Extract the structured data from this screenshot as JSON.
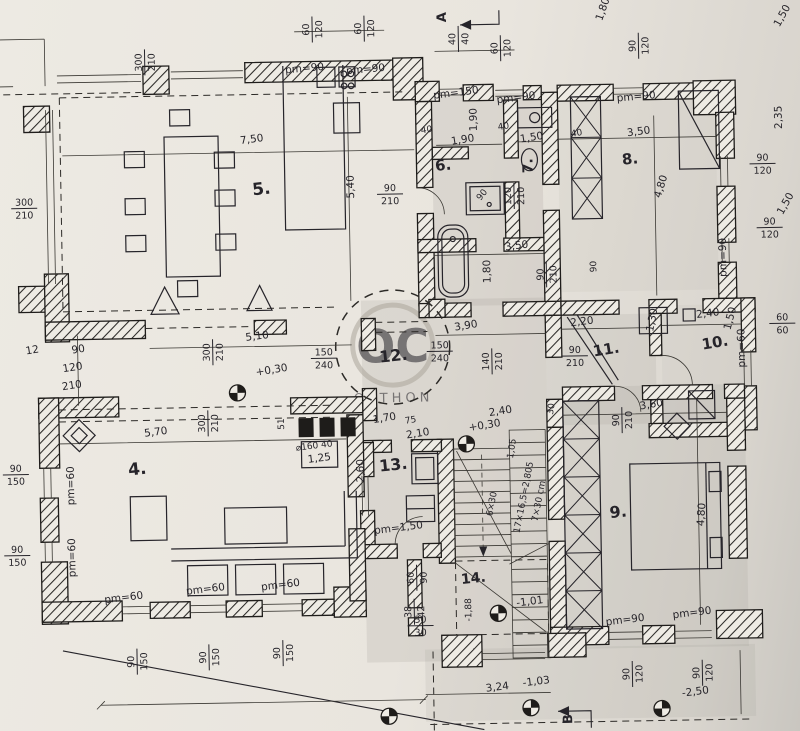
{
  "canvas": {
    "width": 800,
    "height": 731
  },
  "colors": {
    "paper": "#e9e5de",
    "paper_shadow": "#c9c6c0",
    "ink": "#26242a",
    "halftone": "#8e8b85",
    "watermark_gray": "#aba59b"
  },
  "watermark": {
    "monogram": "OC",
    "word": "OTTHON"
  },
  "section_markers": [
    {
      "label": "A",
      "x": 452,
      "y": 18,
      "rot": -90
    },
    {
      "label": "B",
      "x": 566,
      "y": 722,
      "rot": -90
    }
  ],
  "room_labels": [
    {
      "text": "4.",
      "x": 136,
      "y": 470,
      "rot": -5,
      "fs": 17
    },
    {
      "text": "5.",
      "x": 265,
      "y": 192,
      "rot": -5,
      "fs": 17
    },
    {
      "text": "6.",
      "x": 447,
      "y": 171,
      "rot": -5,
      "fs": 15
    },
    {
      "text": "7.",
      "x": 536,
      "y": 168,
      "rot": -90,
      "fs": 14
    },
    {
      "text": "8.",
      "x": 634,
      "y": 168,
      "rot": -5,
      "fs": 15
    },
    {
      "text": "9.",
      "x": 616,
      "y": 521,
      "rot": -5,
      "fs": 16
    },
    {
      "text": "10.",
      "x": 716,
      "y": 353,
      "rot": -8,
      "fs": 15
    },
    {
      "text": "11.",
      "x": 607,
      "y": 358,
      "rot": -8,
      "fs": 15
    },
    {
      "text": "12.",
      "x": 394,
      "y": 361,
      "rot": -5,
      "fs": 16
    },
    {
      "text": "13.",
      "x": 392,
      "y": 470,
      "rot": -5,
      "fs": 16
    },
    {
      "text": "14.",
      "x": 470,
      "y": 584,
      "rot": -5,
      "fs": 14
    }
  ],
  "dim_labels": [
    {
      "text": "pm=90",
      "x": 310,
      "y": 70,
      "rot": -4
    },
    {
      "text": "pm=90",
      "x": 371,
      "y": 72,
      "rot": -4
    },
    {
      "top": "60",
      "bot": "120",
      "x": 318,
      "y": 28,
      "rot": -90
    },
    {
      "top": "60",
      "bot": "120",
      "x": 370,
      "y": 28,
      "rot": -90
    },
    {
      "top": "40",
      "bot": "40",
      "x": 464,
      "y": 40,
      "rot": -90
    },
    {
      "top": "60",
      "bot": "120",
      "x": 506,
      "y": 50,
      "rot": -90
    },
    {
      "top": "90",
      "bot": "120",
      "x": 644,
      "y": 50,
      "rot": -90
    },
    {
      "text": "1,80",
      "x": 612,
      "y": 14,
      "rot": -70
    },
    {
      "text": "1,50",
      "x": 791,
      "y": 24,
      "rot": -60
    },
    {
      "text": "2,35",
      "x": 786,
      "y": 124,
      "rot": -90
    },
    {
      "top": "90",
      "bot": "120",
      "x": 766,
      "y": 170,
      "rot": 0
    },
    {
      "text": "1,50",
      "x": 791,
      "y": 212,
      "rot": -60
    },
    {
      "top": "300",
      "bot": "210",
      "x": 150,
      "y": 58,
      "rot": -90
    },
    {
      "text": "pm=150",
      "x": 461,
      "y": 97,
      "rot": -6
    },
    {
      "text": "pm=90",
      "x": 521,
      "y": 103,
      "rot": -6
    },
    {
      "text": "pm=90",
      "x": 641,
      "y": 104,
      "rot": -4
    },
    {
      "text": "7,50",
      "x": 256,
      "y": 140,
      "rot": -6
    },
    {
      "text": "5,40",
      "x": 357,
      "y": 186,
      "rot": -90
    },
    {
      "top": "90",
      "bot": "210",
      "x": 393,
      "y": 194,
      "rot": 0
    },
    {
      "text": "1,90",
      "x": 467,
      "y": 144,
      "rot": -8
    },
    {
      "text": "1,90",
      "x": 481,
      "y": 121,
      "rot": -90
    },
    {
      "text": "40",
      "x": 431,
      "y": 133,
      "rot": -8,
      "fs": 9
    },
    {
      "text": "40",
      "x": 508,
      "y": 131,
      "rot": -8,
      "fs": 9
    },
    {
      "text": "1,50",
      "x": 536,
      "y": 143,
      "rot": -8
    },
    {
      "text": "40",
      "x": 581,
      "y": 139,
      "rot": -8,
      "fs": 9
    },
    {
      "text": "3,50",
      "x": 643,
      "y": 139,
      "rot": -6
    },
    {
      "top": "120",
      "bot": "210",
      "x": 517,
      "y": 198,
      "rot": -90
    },
    {
      "text": "90",
      "x": 487,
      "y": 198,
      "rot": -50,
      "fs": 9
    },
    {
      "text": "3,50",
      "x": 519,
      "y": 251,
      "rot": -6
    },
    {
      "text": "1,80",
      "x": 492,
      "y": 273,
      "rot": -90
    },
    {
      "top": "90",
      "bot": "210",
      "x": 548,
      "y": 277,
      "rot": -90
    },
    {
      "text": "90",
      "x": 598,
      "y": 270,
      "rot": -90,
      "fs": 9
    },
    {
      "text": "4,80",
      "x": 667,
      "y": 192,
      "rot": -72
    },
    {
      "top": "90",
      "bot": "120",
      "x": 772,
      "y": 234,
      "rot": 0
    },
    {
      "text": "pm=90",
      "x": 728,
      "y": 263,
      "rot": -90
    },
    {
      "top": "300",
      "bot": "210",
      "x": 27,
      "y": 202,
      "rot": 0
    },
    {
      "text": "12",
      "x": 33,
      "y": 347,
      "rot": -8
    },
    {
      "text": "90",
      "x": 79,
      "y": 347,
      "rot": -8
    },
    {
      "text": "120",
      "x": 73,
      "y": 365,
      "rot": -8
    },
    {
      "text": "210",
      "x": 72,
      "y": 383,
      "rot": -8
    },
    {
      "top": "90",
      "bot": "150",
      "x": 14,
      "y": 468,
      "rot": 0
    },
    {
      "top": "90",
      "bot": "150",
      "x": 14,
      "y": 549,
      "rot": 0
    },
    {
      "text": "pm=60",
      "x": 72,
      "y": 480,
      "rot": -90
    },
    {
      "text": "pm=60",
      "x": 72,
      "y": 552,
      "rot": -90
    },
    {
      "text": "5,10",
      "x": 258,
      "y": 337,
      "rot": -6
    },
    {
      "top": "300",
      "bot": "210",
      "x": 213,
      "y": 349,
      "rot": -90
    },
    {
      "top": "150",
      "bot": "240",
      "x": 324,
      "y": 357,
      "rot": 0
    },
    {
      "text": "+0,30",
      "x": 272,
      "y": 371,
      "rot": -8
    },
    {
      "text": "3,90",
      "x": 467,
      "y": 330,
      "rot": -8
    },
    {
      "top": "150",
      "bot": "240",
      "x": 440,
      "y": 352,
      "rot": 0
    },
    {
      "top": "140",
      "bot": "210",
      "x": 492,
      "y": 363,
      "rot": -90
    },
    {
      "text": "2,20",
      "x": 583,
      "y": 328,
      "rot": -6
    },
    {
      "top": "90",
      "bot": "210",
      "x": 575,
      "y": 359,
      "rot": 0
    },
    {
      "text": "1,30",
      "x": 656,
      "y": 325,
      "rot": -78
    },
    {
      "text": "2,40",
      "x": 709,
      "y": 322,
      "rot": -6
    },
    {
      "text": "1,50",
      "x": 734,
      "y": 325,
      "rot": -75
    },
    {
      "top": "60",
      "bot": "60",
      "x": 783,
      "y": 330,
      "rot": 0
    },
    {
      "text": "pm=60",
      "x": 745,
      "y": 354,
      "rot": -90
    },
    {
      "text": "3,60",
      "x": 651,
      "y": 412,
      "rot": -8
    },
    {
      "top": "90",
      "bot": "210",
      "x": 621,
      "y": 424,
      "rot": -90
    },
    {
      "text": "30",
      "x": 553,
      "y": 412,
      "rot": -80,
      "fs": 9
    },
    {
      "text": "2,40",
      "x": 500,
      "y": 416,
      "rot": -8
    },
    {
      "text": "+0,30",
      "x": 484,
      "y": 430,
      "rot": -8
    },
    {
      "text": "1,05",
      "x": 513,
      "y": 451,
      "rot": -80,
      "fs": 9
    },
    {
      "text": "2,10",
      "x": 417,
      "y": 437,
      "rot": -8
    },
    {
      "text": "1,70",
      "x": 384,
      "y": 421,
      "rot": -8
    },
    {
      "text": "75",
      "x": 410,
      "y": 423,
      "rot": -8,
      "fs": 9
    },
    {
      "top": "300",
      "bot": "210",
      "x": 207,
      "y": 420,
      "rot": -90
    },
    {
      "text": "51",
      "x": 283,
      "y": 422,
      "rot": -90,
      "fs": 9
    },
    {
      "text": "5,70",
      "x": 155,
      "y": 431,
      "rot": -6
    },
    {
      "text": "⌀160 40",
      "x": 313,
      "y": 447,
      "rot": -6,
      "fs": 9
    },
    {
      "text": "1,25",
      "x": 318,
      "y": 460,
      "rot": -6
    },
    {
      "text": "2,60",
      "x": 362,
      "y": 470,
      "rot": -90
    },
    {
      "text": "pm=1,50",
      "x": 396,
      "y": 531,
      "rot": -6
    },
    {
      "text": "17×16,5=2,805",
      "x": 524,
      "y": 500,
      "rot": -78,
      "fs": 9
    },
    {
      "text": "7×30 cm",
      "x": 539,
      "y": 504,
      "rot": -78,
      "fs": 9
    },
    {
      "text": "6×30",
      "x": 492,
      "y": 506,
      "rot": -78,
      "fs": 9
    },
    {
      "text": "-1,01",
      "x": 526,
      "y": 607,
      "rot": -6
    },
    {
      "text": "-1,88",
      "x": 467,
      "y": 611,
      "rot": -90,
      "fs": 9
    },
    {
      "top": "60",
      "bot": "90",
      "x": 413,
      "y": 578,
      "rot": -90
    },
    {
      "top": "38",
      "bot": "42",
      "x": 410,
      "y": 612,
      "rot": -90
    },
    {
      "top": "30",
      "bot": "30",
      "x": 416,
      "y": 626,
      "rot": 0
    },
    {
      "text": "pm=60",
      "x": 120,
      "y": 596,
      "rot": -6
    },
    {
      "text": "pm=60",
      "x": 202,
      "y": 589,
      "rot": -6
    },
    {
      "text": "pm=60",
      "x": 277,
      "y": 586,
      "rot": -6
    },
    {
      "top": "90",
      "bot": "150",
      "x": 132,
      "y": 657,
      "rot": -90
    },
    {
      "top": "90",
      "bot": "150",
      "x": 204,
      "y": 654,
      "rot": -90
    },
    {
      "top": "90",
      "bot": "150",
      "x": 278,
      "y": 651,
      "rot": -90
    },
    {
      "text": "3,24",
      "x": 492,
      "y": 692,
      "rot": -6
    },
    {
      "text": "-1,03",
      "x": 531,
      "y": 687,
      "rot": -6
    },
    {
      "text": "pm=90",
      "x": 621,
      "y": 627,
      "rot": -6
    },
    {
      "text": "pm=90",
      "x": 688,
      "y": 621,
      "rot": -6
    },
    {
      "top": "90",
      "bot": "120",
      "x": 627,
      "y": 678,
      "rot": -90
    },
    {
      "top": "90",
      "bot": "120",
      "x": 697,
      "y": 678,
      "rot": -90
    },
    {
      "text": "-2,50",
      "x": 690,
      "y": 700,
      "rot": -6
    },
    {
      "text": "4,80",
      "x": 702,
      "y": 520,
      "rot": -85
    }
  ],
  "benchmarks": [
    {
      "x": 237,
      "y": 390
    },
    {
      "x": 465,
      "y": 445
    },
    {
      "x": 494,
      "y": 615
    },
    {
      "x": 525,
      "y": 710
    },
    {
      "x": 656,
      "y": 713
    },
    {
      "x": 383,
      "y": 716
    }
  ]
}
